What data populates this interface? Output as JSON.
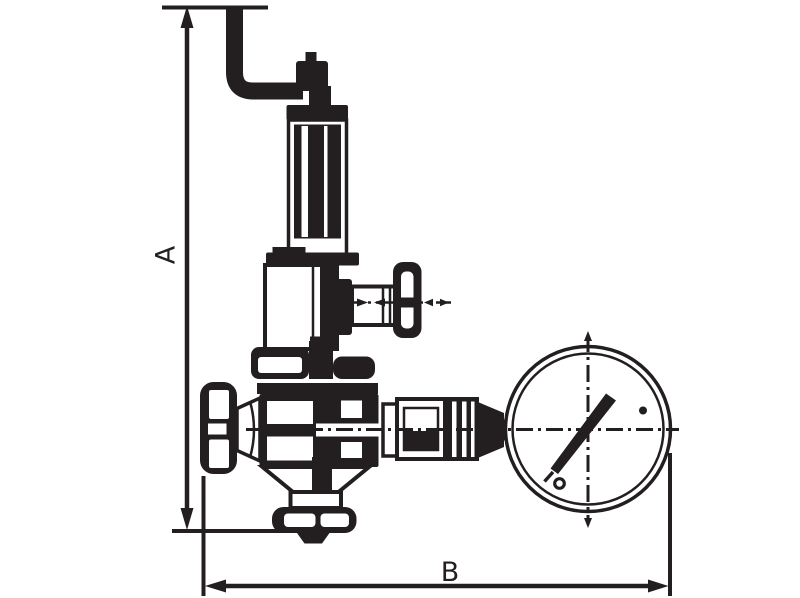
{
  "labels": {
    "dimension_vertical": "A",
    "dimension_horizontal": "B"
  },
  "colors": {
    "ink": "#231f20",
    "background": "#ffffff"
  },
  "components": [
    "bent-adjusting-handle",
    "adjusting-nut",
    "threaded-stem",
    "locknut-collar",
    "spring-housing",
    "diaphragm-chamber",
    "t-handle-set-screw",
    "bonnet-flange",
    "valve-body",
    "handwheel",
    "bottom-outlet-flange",
    "gauge-union-fitting",
    "pressure-gauge",
    "gauge-needle",
    "dimension-line-a",
    "dimension-line-b"
  ]
}
